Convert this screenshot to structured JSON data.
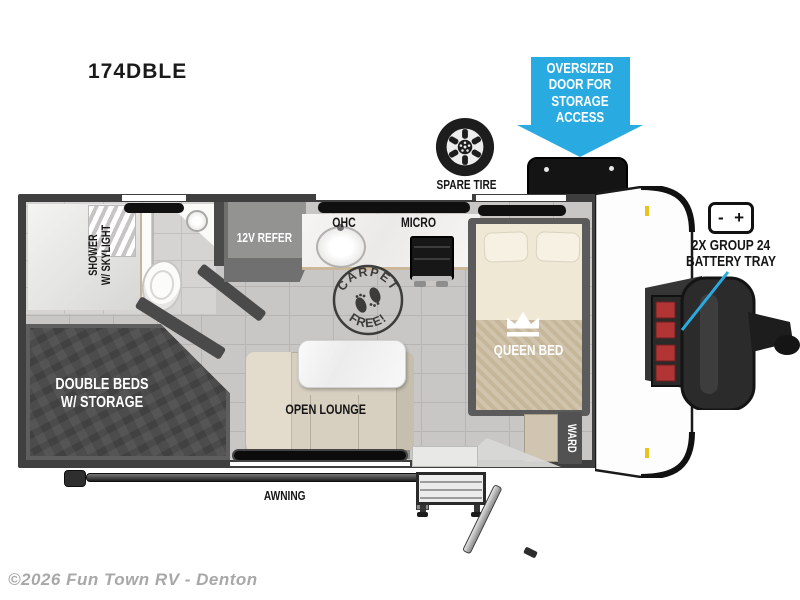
{
  "page": {
    "model": "174DBLE",
    "copyright": "©2026 Fun Town RV - Denton"
  },
  "callouts": {
    "oversized_door": {
      "line1": "OVERSIZED",
      "line2": "DOOR FOR",
      "line3": "STORAGE",
      "line4": "ACCESS"
    },
    "spare_tire_label": "SPARE TIRE",
    "battery": {
      "line1": "2X GROUP 24",
      "line2": "BATTERY TRAY",
      "minus": "-",
      "plus": "+"
    }
  },
  "labels": {
    "shower": {
      "line1": "SHOWER",
      "line2": "W/ SKYLIGHT"
    },
    "refer": "12V REFER",
    "ohc": "OHC",
    "micro": "MICRO",
    "queen_bed": "QUEEN BED",
    "ward": "WARD",
    "double_beds": {
      "line1": "DOUBLE BEDS",
      "line2": "W/ STORAGE"
    },
    "open_lounge": "OPEN LOUNGE",
    "awning": "AWNING",
    "carpet": {
      "top": "CARPET",
      "bottom": "FREE!"
    }
  },
  "colors": {
    "accent_blue": "#29abe2",
    "wall_gray": "#3f3f3f",
    "floor_tile": "#c8c7c5",
    "bed_blanket_tan": "#c6b79b",
    "sofa_beige": "#d7d0c1",
    "charcoal_beds": "#4c4c4c",
    "marker_red": "#b23434"
  }
}
